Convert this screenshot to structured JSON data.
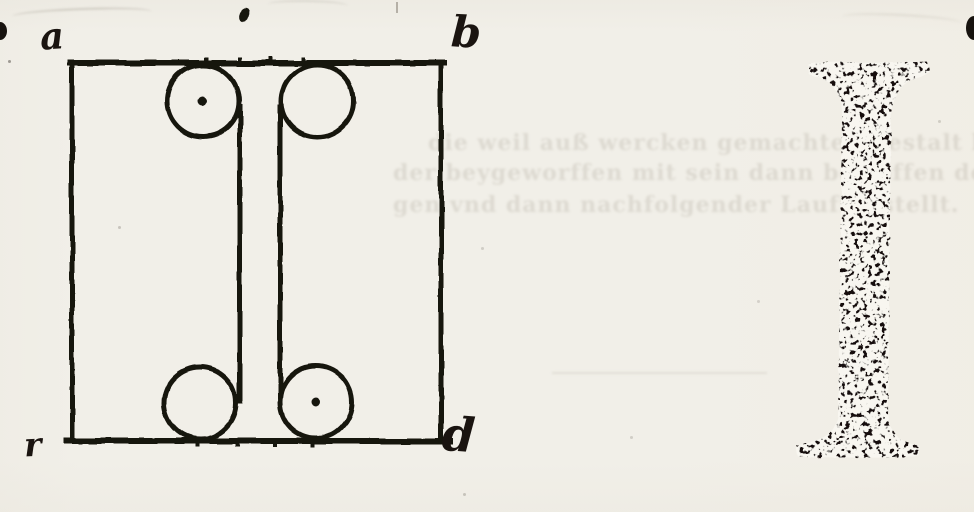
{
  "page": {
    "kind": "scanned woodcut book page: geometric construction of the roman capital letter I",
    "paper_color": "#f1efe8",
    "ink_color": "#191410"
  },
  "construction_figure": {
    "corner_labels": {
      "top_left": "a",
      "top_right": "b",
      "bottom_left": "r",
      "bottom_right": "d"
    },
    "geometry": {
      "square": {
        "x": 72,
        "y": 63,
        "w": 369,
        "h": 378
      },
      "circles": [
        {
          "cx": 203,
          "cy": 101,
          "r": 36,
          "dot": true
        },
        {
          "cx": 317,
          "cy": 101,
          "r": 36,
          "dot": false
        },
        {
          "cx": 200,
          "cy": 403,
          "r": 36,
          "dot": false
        },
        {
          "cx": 316,
          "cy": 402,
          "r": 36,
          "dot": true
        }
      ],
      "stem_lines": [
        {
          "x": 240,
          "y1": 104,
          "y2": 404
        },
        {
          "x": 280,
          "y1": 104,
          "y2": 400
        }
      ],
      "ticks_top": [
        206,
        240,
        271,
        303
      ],
      "ticks_bottom": [
        197,
        237,
        275,
        313
      ],
      "ink_blot": {
        "x": 245,
        "y": 15
      }
    }
  },
  "letter_specimen": {
    "letter": "I",
    "style": "roman capital with flared serifs, distressed woodcut print"
  },
  "bleedthrough": {
    "lines": [
      {
        "text": "die weil auß wercken gemachten gestalt bekannt deiner dem"
      },
      {
        "text": "der beygeworffen mit sein dann bey offen der gemelten vnd wol"
      },
      {
        "text": "gen vnd dann nachfolgender Lauffgestellt."
      }
    ]
  }
}
